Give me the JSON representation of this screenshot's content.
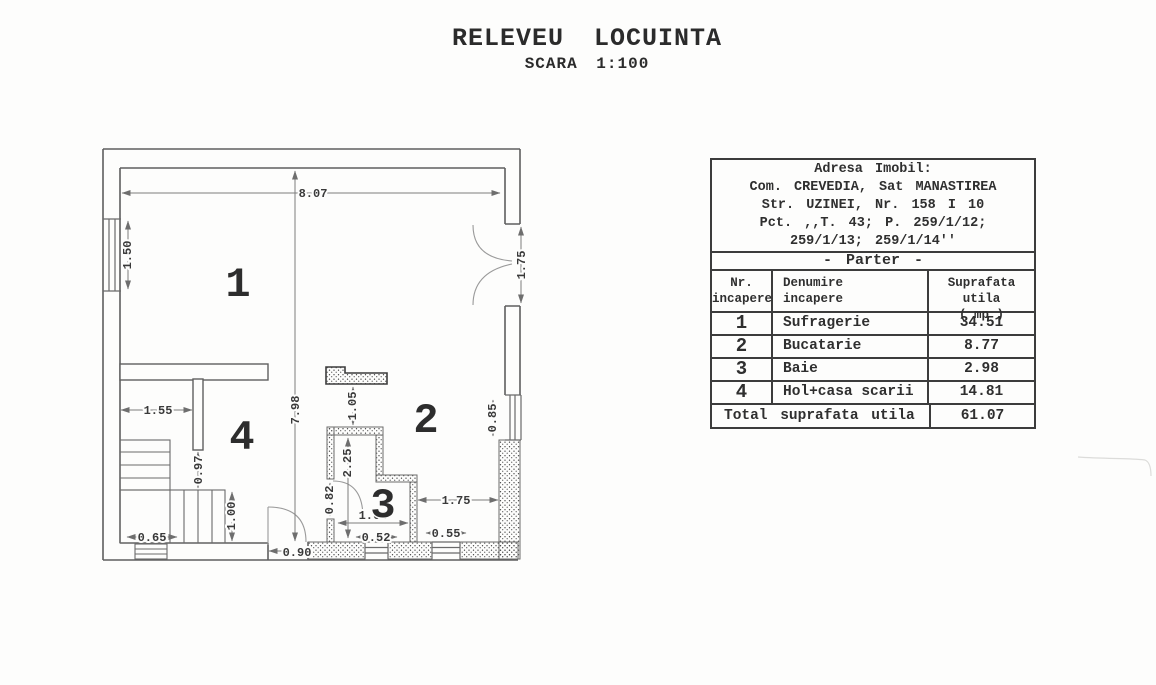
{
  "title": {
    "main": "RELEVEU LOCUINTA",
    "scale": "SCARA 1:100"
  },
  "info": {
    "address_title": "Adresa Imobil:",
    "address_line2": "Com. CREVEDIA, Sat MANASTIREA",
    "address_line3": "Str. UZINEI, Nr. 158 I 10",
    "address_line4": "Pct. ,,T. 43; P. 259/1/12;",
    "address_line5": "259/1/13; 259/1/14''",
    "floor": "- Parter -",
    "col_nr_1": "Nr.",
    "col_nr_2": "incapere",
    "col_name_1": "Denumire",
    "col_name_2": "incapere",
    "col_area_1": "Suprafata utila",
    "col_area_2": "( mp )",
    "rows": [
      {
        "nr": "1",
        "name": "Sufragerie",
        "area": "34.51"
      },
      {
        "nr": "2",
        "name": "Bucatarie",
        "area": "8.77"
      },
      {
        "nr": "3",
        "name": "Baie",
        "area": "2.98"
      },
      {
        "nr": "4",
        "name": "Hol+casa scarii",
        "area": "14.81"
      }
    ],
    "total_label": "Total suprafata utila",
    "total_value": "61.07"
  },
  "plan": {
    "room_labels": {
      "r1": "1",
      "r2": "2",
      "r3": "3",
      "r4": "4"
    },
    "dims": {
      "width_top": "8.07",
      "height_left": "7.98",
      "window_left": "1.50",
      "door_right": "1.75",
      "hall_width": "1.55",
      "wall_stub": "0.97",
      "stairs": "1.00",
      "step": "0.65",
      "entry_door": "0.90",
      "counter_gap": "1.05",
      "bath_height": "2.25",
      "bath_door": "0.82",
      "bath_width": "1.64",
      "window_bottom_1": "0.52",
      "window_bottom_2": "0.55",
      "kitchen_right": "1.75",
      "window_right": "0.85"
    }
  }
}
